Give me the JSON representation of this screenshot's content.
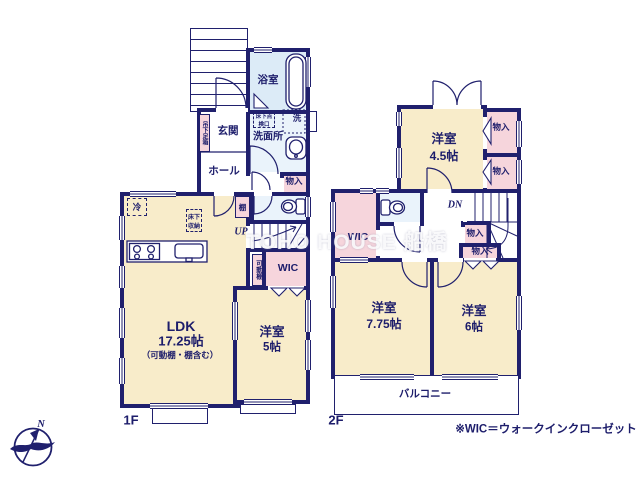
{
  "watermark": "TOHO HOUSE 船橋",
  "note": "※WIC＝ウォークインクローゼット",
  "compass_n": "N",
  "colors": {
    "wall": "#20206d",
    "room_cream": "#f8ecca",
    "closet_pink": "#f6d5dc",
    "bath_blue": "#dcebf7",
    "sanitary_blue": "#eaf3fb",
    "label_navy": "#1d1d6b"
  },
  "floor1": {
    "floor_label": "1F",
    "bath": "浴室",
    "entrance": "玄関",
    "shoe_cabinet": "吊下足箱",
    "washroom": "洗面所",
    "inspection_hatch": "床下点検口",
    "washer": "洗",
    "hall": "ホール",
    "closet": "物入",
    "fridge": "冷",
    "shelf": "棚",
    "underfloor_storage": "床下収納",
    "up": "UP",
    "movable_shelf": "可動棚",
    "wic": "WIC",
    "ldk_name": "LDK",
    "ldk_size": "17.25帖",
    "ldk_note": "（可動棚・棚含む）",
    "bedroom_name": "洋室",
    "bedroom_size": "5帖"
  },
  "floor2": {
    "floor_label": "2F",
    "bedroom1_name": "洋室",
    "bedroom1_size": "4.5帖",
    "closets": [
      "物入",
      "物入",
      "物入",
      "物入"
    ],
    "dn": "DN",
    "wic": "WIC",
    "bedroom2_name": "洋室",
    "bedroom2_size": "7.75帖",
    "bedroom3_name": "洋室",
    "bedroom3_size": "6帖",
    "balcony": "バルコニー"
  }
}
